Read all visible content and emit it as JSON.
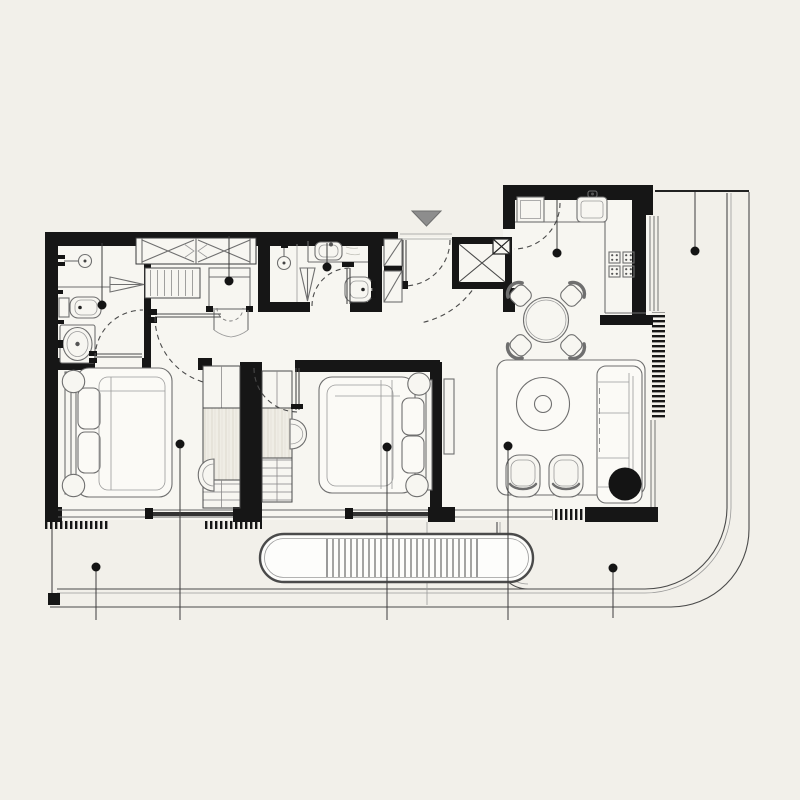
{
  "meta": {
    "type": "architectural-floor-plan",
    "visible_text": "none",
    "style": "black-wall line drawing on cream background"
  },
  "palette": {
    "bg": "#F2F0EA",
    "room": "#F7F6F1",
    "rug": "#FBFAF6",
    "wall": "#161616",
    "line": "#4A4A4A",
    "line_light": "#8F8F8F",
    "wood_base": "#EFEDE5",
    "wood_grain": "#D8D4C8",
    "entry_marker": "#8D8D8D",
    "white": "#FFFFFF"
  },
  "entry_marker": {
    "shape": "triangle-down",
    "x": 426,
    "y": 218
  },
  "leader_markers": [
    {
      "x": 102,
      "y": 305,
      "line_to": 243
    },
    {
      "x": 229,
      "y": 281,
      "line_to": 236
    },
    {
      "x": 327,
      "y": 267,
      "line_to": 243
    },
    {
      "x": 557,
      "y": 253,
      "line_to": 200
    },
    {
      "x": 695,
      "y": 251,
      "line_to": 192
    },
    {
      "x": 180,
      "y": 444,
      "line_to": 620
    },
    {
      "x": 387,
      "y": 447,
      "line_to": 620
    },
    {
      "x": 508,
      "y": 446,
      "line_to": 620
    },
    {
      "x": 96,
      "y": 567,
      "line_to": 620
    },
    {
      "x": 613,
      "y": 568,
      "line_to": 618
    }
  ],
  "planter": {
    "x": 260,
    "y": 534,
    "width": 273,
    "height": 48,
    "stripe_x1": 327,
    "stripe_x2": 477,
    "stripe_step": 6,
    "stripe_y1": 539,
    "stripe_y2": 577
  }
}
